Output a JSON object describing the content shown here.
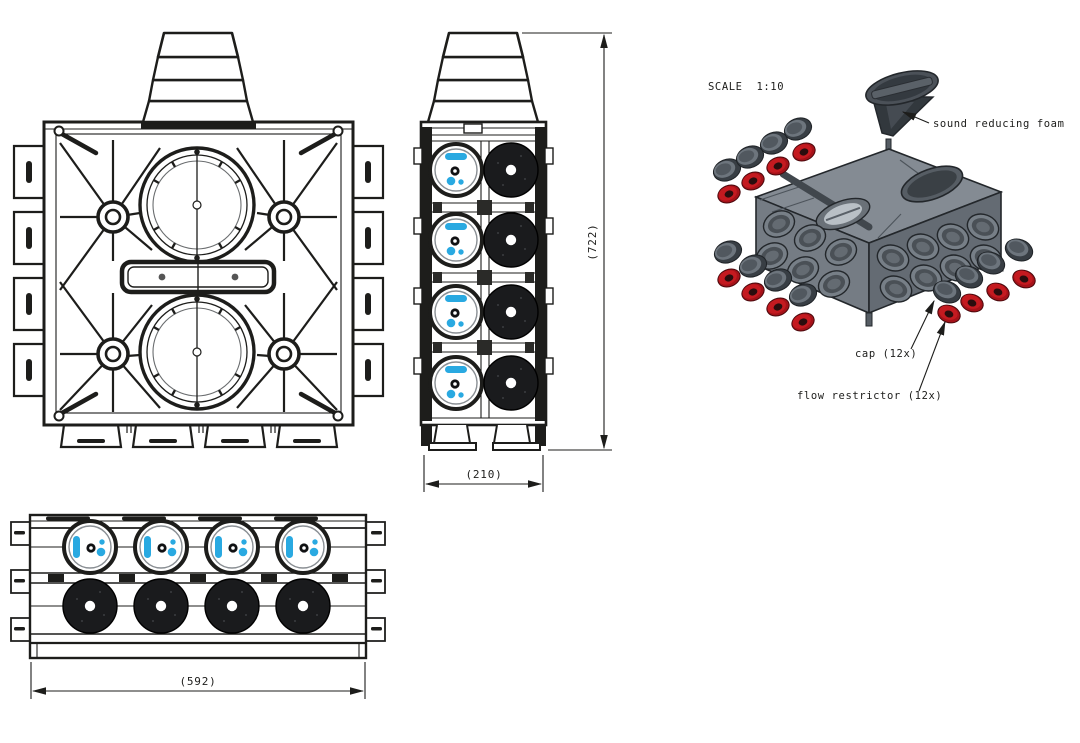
{
  "drawing": {
    "scale_label": "SCALE  1:10",
    "dimensions": {
      "height": "(722)",
      "depth": "(210)",
      "width": "(592)"
    },
    "annotations": {
      "foam": "sound reducing foam",
      "cap": "cap (12x)",
      "restrictor": "flow restrictor (12x)"
    },
    "parts": {
      "cap_count": "12",
      "restrictor_count": "12"
    },
    "colors": {
      "line": "#1d1d1b",
      "accent_blue": "#29a9e1",
      "restrictor_red": "#b01218",
      "cap_gray": "#50575e",
      "body_gray": "#848b93",
      "port_black": "#1a1b1d"
    }
  }
}
